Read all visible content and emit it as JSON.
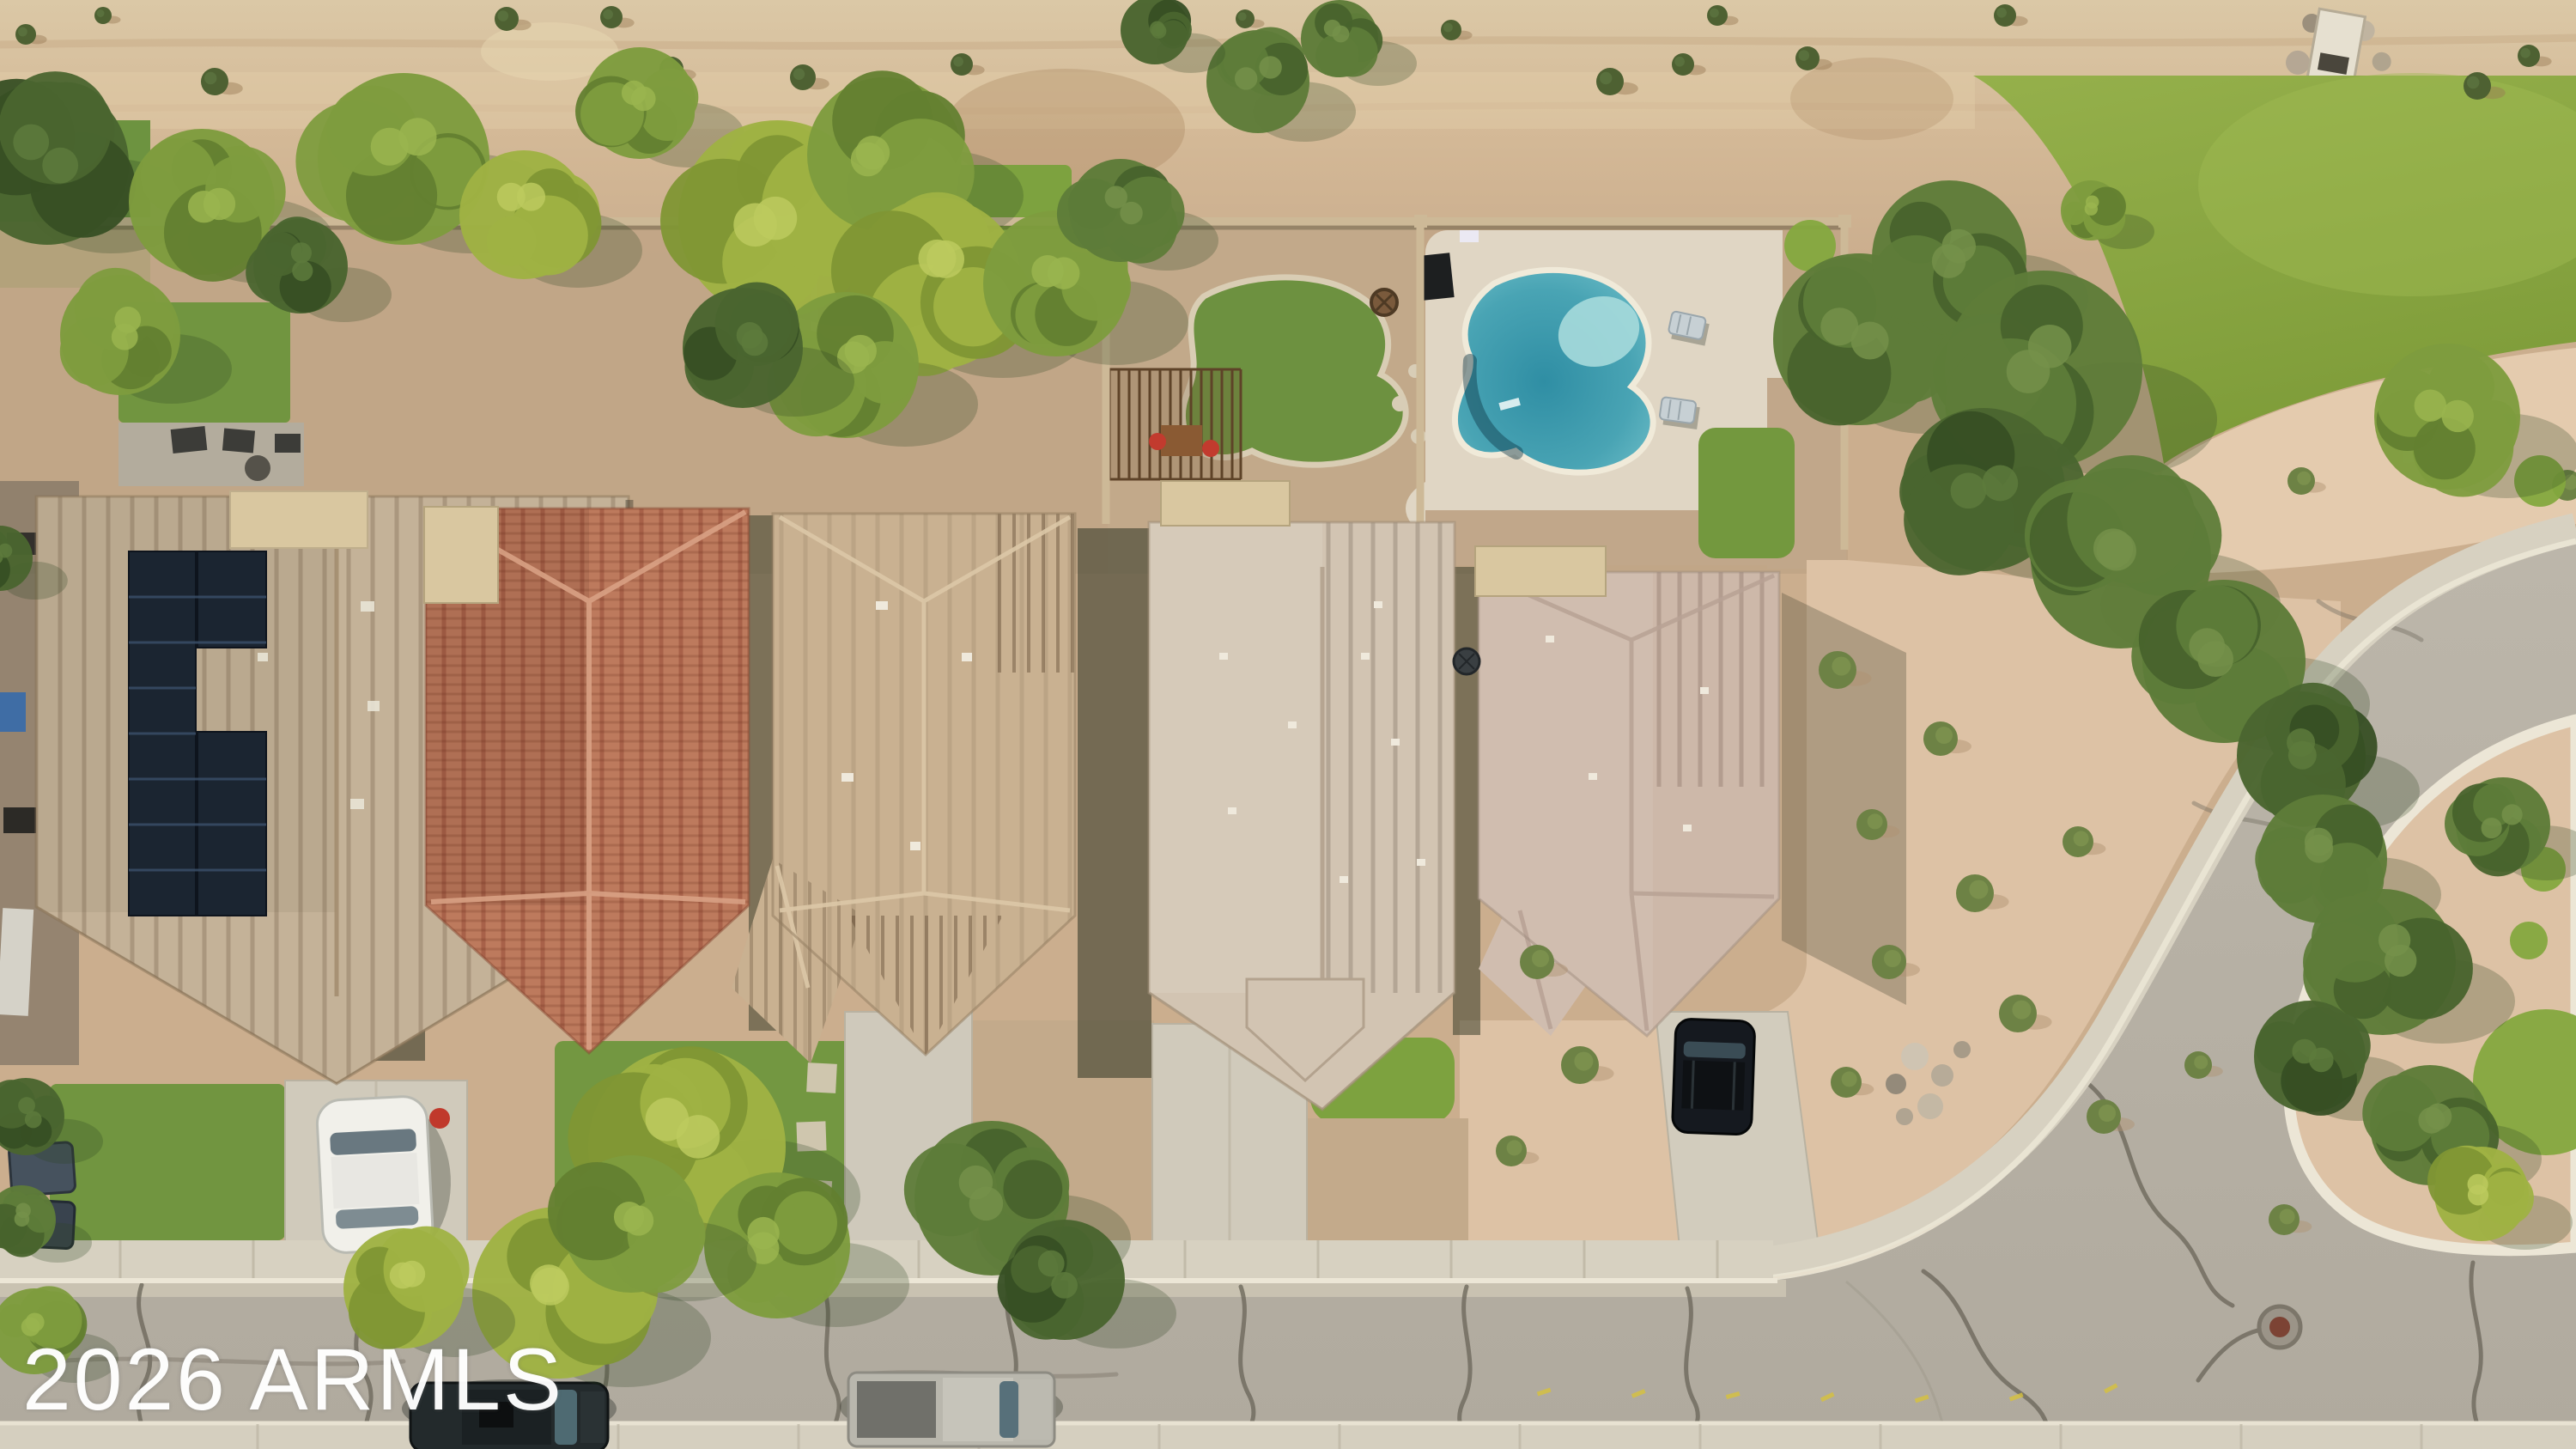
{
  "image": {
    "type": "aerial-drone-photograph",
    "subject": "top-down view of a residential desert neighborhood: five tile-roof houses in a row, backyard kidney pool, solar panels, desert dirt strip, green park, curved street with cul-de-sac island, parked vehicles"
  },
  "watermark": {
    "text": "2026 ARMLS",
    "color": "#ffffff"
  },
  "palette": {
    "dirt": "#cbae8e",
    "dirtLight": "#ddc9a6",
    "dirtStain": "#a8825c",
    "granite": "#ddc2a5",
    "graniteLight": "#e4cbae",
    "parkLawn": "#8aa73f",
    "yardLawn": "#719540",
    "brightLawn": "#7da23f",
    "road": "#b6b0a4",
    "sidewalk": "#d7d1c1",
    "gutter": "#ccc5b4",
    "curb": "#ece6d6",
    "crack": "#6e695d",
    "wall": "#cdb997",
    "roof1": "#c4b298",
    "roof2": "#bd7a5d",
    "roof3": "#c9b191",
    "roof4": "#d2c4b2",
    "roof5": "#cdb8a9",
    "flatRoof": "#d9c7a0",
    "solar": "#1b2531",
    "poolDeck": "#e0d6c4",
    "poolWater": "#3d9cae",
    "poolShallow": "#a6dadc",
    "treeShadow": "#2e4423",
    "carWhite": "#f1f0ea",
    "carBlack": "#15191f",
    "suvDark": "#232a2c",
    "truckSilver": "#b9b7ad",
    "binBlue": "#46525e"
  },
  "treeTones": {
    "bright": [
      "#9fb243",
      "#7f9634",
      "#bcca5e"
    ],
    "mid": [
      "#7e9c3e",
      "#637f30",
      "#9ab54f"
    ],
    "olive": [
      "#5e7c39",
      "#48632c",
      "#74914a"
    ],
    "dark": [
      "#4a652f",
      "#374f24",
      "#5d7a3c"
    ]
  },
  "scene": {
    "houses": [
      {
        "label": "house-1-tan-roof-with-solar-panels"
      },
      {
        "label": "house-2-terracotta-tile-roof"
      },
      {
        "label": "house-3-tan-cross-hip-tile-roof"
      },
      {
        "label": "house-4-light-tan-long-ridge-roof"
      },
      {
        "label": "house-5-mauve-tile-roof"
      }
    ],
    "pool": {
      "label": "kidney-shaped-swimming-pool"
    },
    "vehicles": [
      {
        "label": "white-sedan-in-driveway"
      },
      {
        "label": "black-suv-in-driveway"
      },
      {
        "label": "dark-suv-parked-on-street"
      },
      {
        "label": "silver-pickup-parked-on-street"
      }
    ],
    "trees": [
      [
        55,
        190,
        95,
        "dark"
      ],
      [
        235,
        235,
        85,
        "mid"
      ],
      [
        140,
        390,
        70,
        "mid"
      ],
      [
        470,
        185,
        100,
        "mid"
      ],
      [
        610,
        250,
        75,
        "bright"
      ],
      [
        350,
        310,
        55,
        "dark"
      ],
      [
        745,
        120,
        65,
        "mid"
      ],
      [
        1465,
        95,
        60,
        "olive"
      ],
      [
        1560,
        45,
        45,
        "olive"
      ],
      [
        1345,
        35,
        40,
        "dark"
      ],
      [
        905,
        255,
        115,
        "bright"
      ],
      [
        1030,
        180,
        90,
        "mid"
      ],
      [
        1090,
        330,
        100,
        "bright"
      ],
      [
        985,
        425,
        85,
        "mid"
      ],
      [
        865,
        405,
        70,
        "dark"
      ],
      [
        1230,
        330,
        85,
        "mid"
      ],
      [
        1305,
        245,
        60,
        "olive"
      ],
      [
        2165,
        395,
        100,
        "olive"
      ],
      [
        2270,
        300,
        90,
        "olive"
      ],
      [
        2380,
        430,
        115,
        "olive"
      ],
      [
        2310,
        570,
        95,
        "dark"
      ],
      [
        2470,
        650,
        105,
        "olive"
      ],
      [
        2590,
        770,
        95,
        "olive"
      ],
      [
        2680,
        880,
        75,
        "dark"
      ],
      [
        2850,
        485,
        85,
        "mid"
      ],
      [
        2705,
        1000,
        75,
        "olive"
      ],
      [
        2775,
        1120,
        85,
        "olive"
      ],
      [
        2690,
        1230,
        65,
        "dark"
      ],
      [
        2830,
        1310,
        70,
        "olive"
      ],
      [
        2915,
        960,
        55,
        "olive"
      ],
      [
        2890,
        1390,
        55,
        "bright"
      ],
      [
        650,
        1505,
        100,
        "bright"
      ],
      [
        800,
        1335,
        115,
        "bright"
      ],
      [
        905,
        1450,
        85,
        "mid"
      ],
      [
        735,
        1425,
        80,
        "mid"
      ],
      [
        1155,
        1395,
        90,
        "olive"
      ],
      [
        1240,
        1490,
        70,
        "dark"
      ],
      [
        470,
        1500,
        70,
        "bright"
      ],
      [
        2435,
        245,
        35,
        "mid"
      ],
      [
        30,
        1300,
        45,
        "dark"
      ],
      [
        25,
        1420,
        40,
        "olive"
      ],
      [
        40,
        1550,
        50,
        "mid"
      ],
      [
        0,
        650,
        38,
        "dark"
      ]
    ],
    "dirtShrubs": [
      [
        250,
        95,
        16
      ],
      [
        590,
        22,
        14
      ],
      [
        712,
        20,
        13
      ],
      [
        782,
        80,
        14
      ],
      [
        935,
        90,
        15
      ],
      [
        1120,
        75,
        13
      ],
      [
        1875,
        95,
        16
      ],
      [
        1960,
        75,
        13
      ],
      [
        2105,
        68,
        14
      ],
      [
        2000,
        18,
        12
      ],
      [
        2335,
        18,
        13
      ],
      [
        1690,
        35,
        12
      ],
      [
        1450,
        22,
        11
      ],
      [
        2885,
        100,
        16
      ],
      [
        2945,
        65,
        13
      ],
      [
        30,
        40,
        12
      ],
      [
        120,
        18,
        10
      ]
    ],
    "desertShrubs": [
      [
        2140,
        780,
        22
      ],
      [
        2260,
        860,
        20
      ],
      [
        2180,
        960,
        18
      ],
      [
        2300,
        1040,
        22
      ],
      [
        2420,
        980,
        18
      ],
      [
        2200,
        1120,
        20
      ],
      [
        2350,
        1180,
        22
      ],
      [
        2150,
        1260,
        18
      ],
      [
        2450,
        1300,
        20
      ],
      [
        2560,
        1240,
        16
      ],
      [
        2660,
        1420,
        18
      ],
      [
        1790,
        1120,
        20
      ],
      [
        1840,
        1240,
        22
      ],
      [
        1760,
        1340,
        18
      ],
      [
        2680,
        560,
        16
      ],
      [
        2990,
        565,
        18
      ]
    ],
    "grassCircles": [
      [
        2905,
        492,
        26
      ],
      [
        2958,
        560,
        30
      ],
      [
        2962,
        1012,
        26
      ],
      [
        2945,
        1095,
        22
      ],
      [
        2965,
        1260,
        85
      ],
      [
        2108,
        286,
        30
      ]
    ]
  }
}
